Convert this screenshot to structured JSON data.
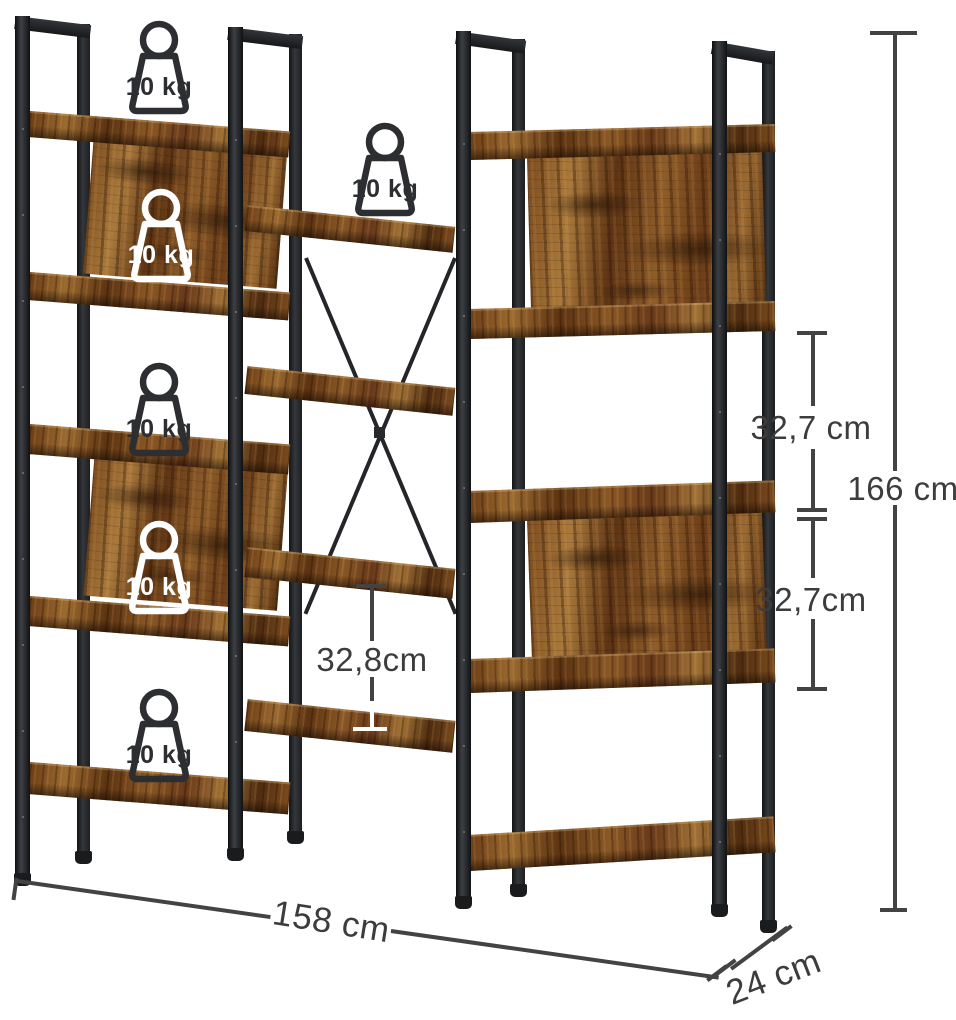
{
  "product_overlay": {
    "capacity_label": "10 kg",
    "capacity_icons_count": 6
  },
  "dimensions": {
    "width": "158 cm",
    "depth": "24 cm",
    "height": "166 cm",
    "right_upper_shelf_gap": "32,7 cm",
    "right_lower_shelf_gap": "32,7cm",
    "middle_shelf_gap": "32,8cm"
  },
  "style": {
    "background": "#ffffff",
    "frame_color": "#26272b",
    "wood_light": "#a9793c",
    "wood_mid": "#8a5826",
    "wood_dark": "#55300f",
    "annotation_color": "#3c3c3c",
    "annotation_light": "#ffffff"
  }
}
